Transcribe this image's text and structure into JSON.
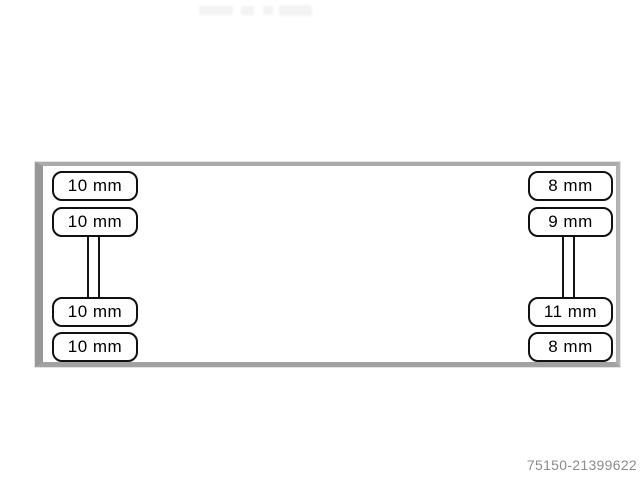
{
  "window": {
    "background": "#ffffff"
  },
  "diagram": {
    "type": "tire-tread-depth-schematic",
    "outline_color": "#989898",
    "label_border_color": "#111111",
    "unit": "mm",
    "tires": {
      "left": [
        "10 mm",
        "10 mm",
        "10 mm",
        "10 mm"
      ],
      "right": [
        "8 mm",
        "9 mm",
        "11 mm",
        "8 mm"
      ]
    }
  },
  "footer": {
    "image_id": "75150-21399622"
  }
}
